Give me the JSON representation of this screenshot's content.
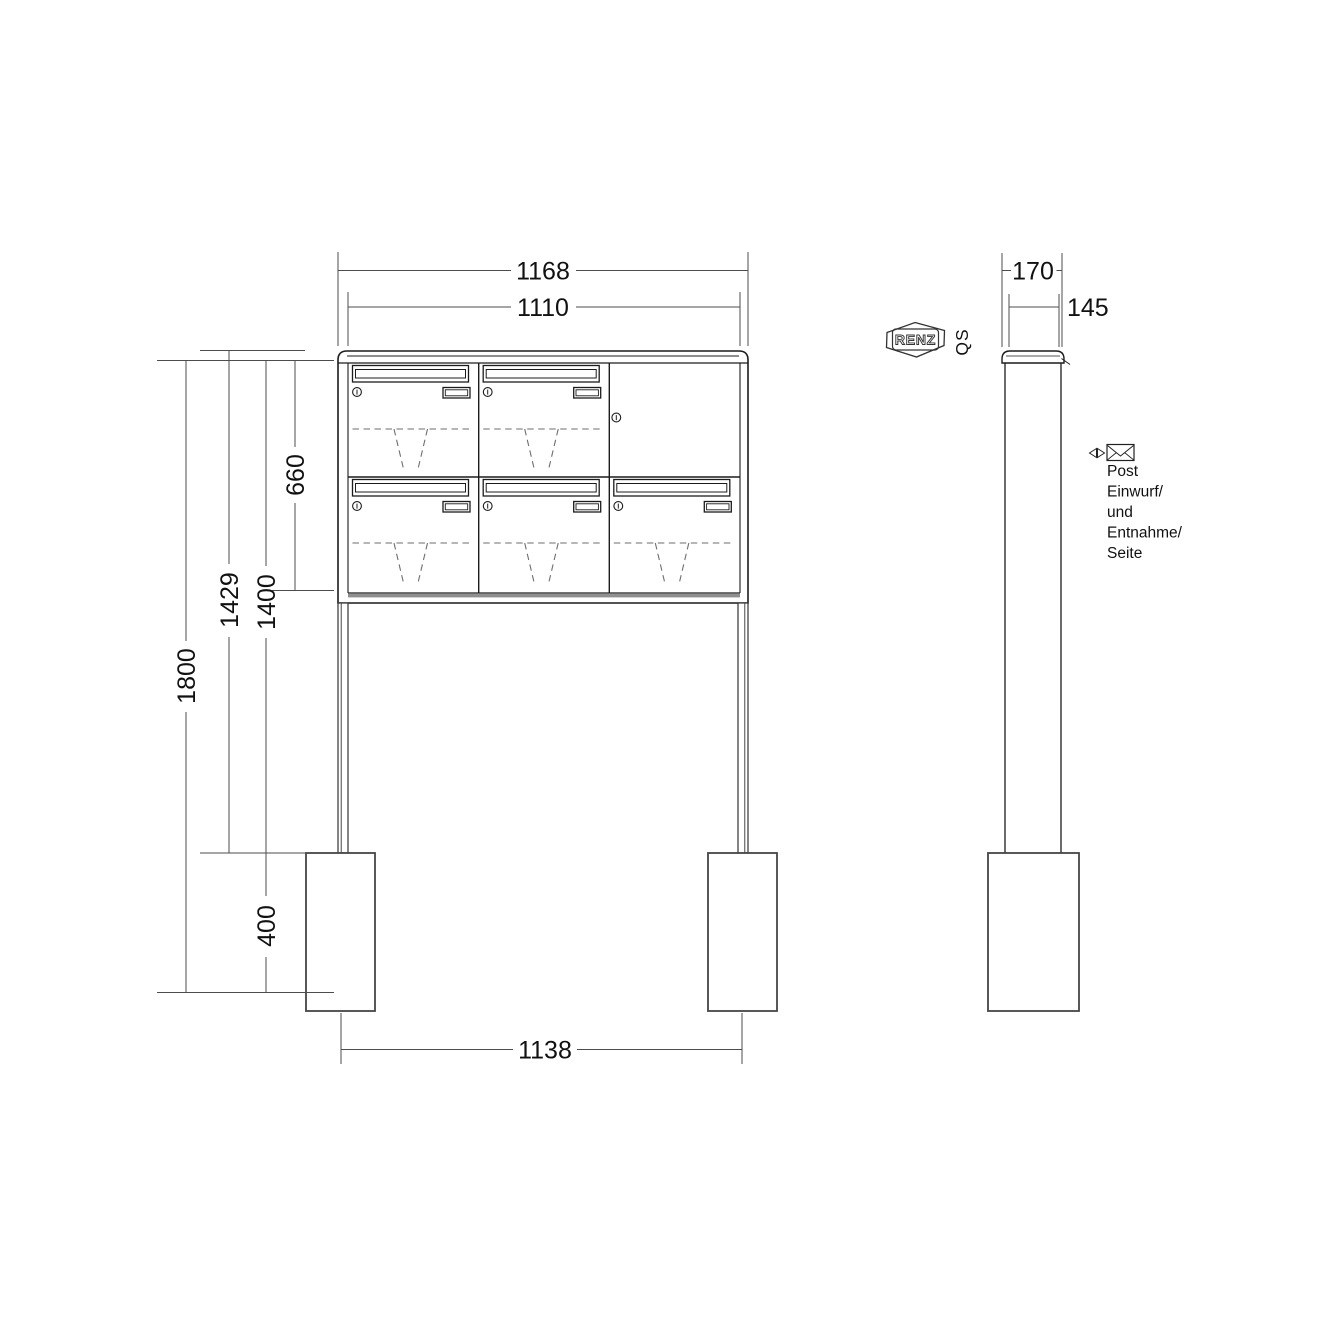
{
  "front_view": {
    "dims": {
      "width_outer": "1168",
      "width_inner": "1110",
      "cabinet_height": "660",
      "height_to_cap_top": "1429",
      "height_to_body_top": "1400",
      "total_height": "1800",
      "anchor_depth": "400",
      "anchor_spacing": "1138"
    }
  },
  "side_view": {
    "dims": {
      "depth_outer": "170",
      "depth_inner": "145"
    }
  },
  "branding": {
    "logo_text": "RENZ",
    "qs_label": "QS"
  },
  "annotation": {
    "line1": "Post",
    "line2": "Einwurf/",
    "line3": "und",
    "line4": "Entnahme/",
    "line5": "Seite"
  },
  "colors": {
    "line": "#1c1c1c",
    "dim_line": "#4d4d4d",
    "dashed_line": "#6e6e6e",
    "band": "#8f8f8f",
    "background": "#ffffff"
  }
}
